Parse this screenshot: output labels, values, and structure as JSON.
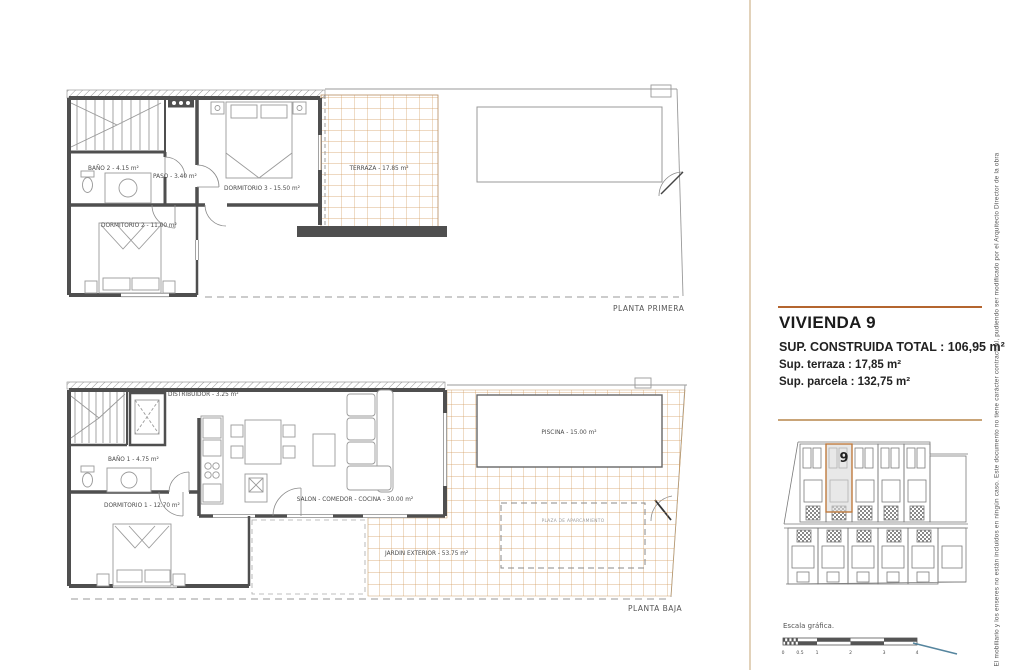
{
  "plans": {
    "primera": {
      "title": "PLANTA PRIMERA",
      "rooms": {
        "bano2": "BAÑO 2 - 4.15 m²",
        "paso": "PASO - 3.40 m²",
        "dormitorio3": "DORMITORIO 3 - 15.50 m²",
        "dormitorio2": "DORMITORIO 2 - 11.00 m²",
        "terraza": "TERRAZA - 17.85 m²"
      }
    },
    "baja": {
      "title": "PLANTA BAJA",
      "rooms": {
        "distribuidor": "DISTRIBUIDOR - 3.25 m²",
        "bano1": "BAÑO 1 - 4.75 m²",
        "dormitorio1": "DORMITORIO 1 - 12.70 m²",
        "salon": "SALON - COMEDOR - COCINA - 30.00 m²",
        "piscina": "PISCINA - 15.00 m²",
        "jardin": "JARDIN EXTERIOR - 53.75 m²",
        "aparcamiento": "PLAZA DE APARCAMIENTO"
      }
    }
  },
  "info_panel": {
    "title": "VIVIENDA 9",
    "sup_construida": "SUP. CONSTRUIDA TOTAL : 106,95 m²",
    "sup_terraza": "Sup. terraza : 17,85 m²",
    "sup_parcela": "Sup. parcela : 132,75 m²"
  },
  "site_plan": {
    "unit_number": "9"
  },
  "scale": {
    "label": "Escala gráfica.",
    "ticks": [
      "0",
      "0.5",
      "1",
      "2",
      "3",
      "4"
    ]
  },
  "disclaimer": "El mobiliario y los enseres no están incluidos en ningún caso. Este documento no tiene carácter contractual, pudiendo ser modificado por el Arquitecto Director de la obra",
  "colors": {
    "accent_rule_dark": "#b4652f",
    "accent_rule_light": "#c9a478",
    "panel_divider": "#e2d2ba",
    "tile_grid": "#d29a5e",
    "wall": "#4f4f4f",
    "unit_highlight_border": "#bf7a3e",
    "unit_highlight_fill": "#d8d8d8",
    "north_mark_blue": "#55859e"
  }
}
